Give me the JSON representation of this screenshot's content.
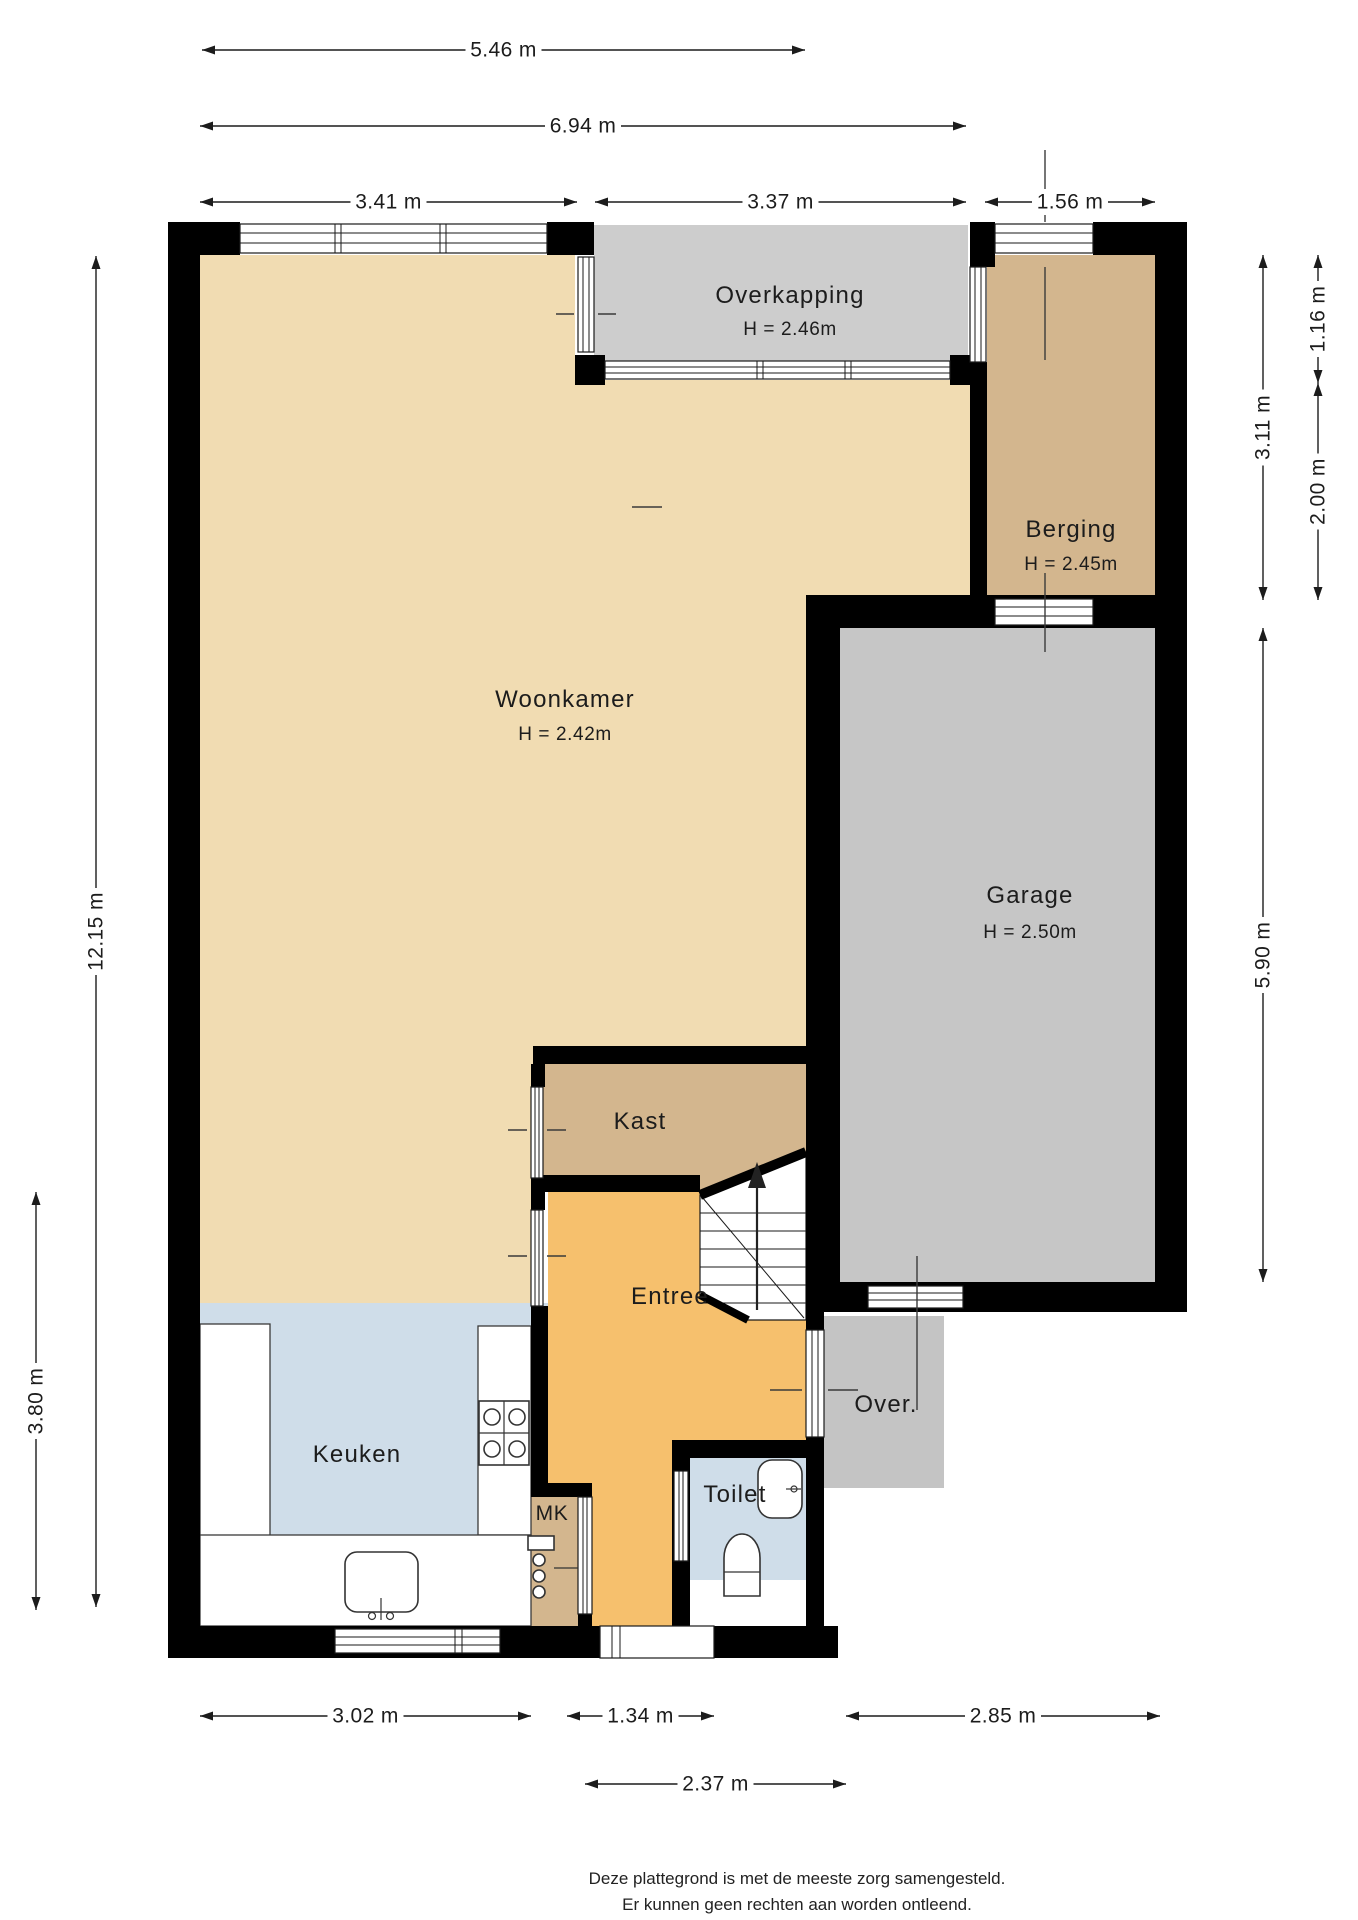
{
  "footer": {
    "line1": "Deze plattegrond is met de meeste zorg samengesteld.",
    "line2": "Er kunnen geen rechten aan worden ontleend."
  },
  "rooms": [
    {
      "id": "woonkamer",
      "label": "Woonkamer",
      "height": "H = 2.42m"
    },
    {
      "id": "overkapping",
      "label": "Overkapping",
      "height": "H = 2.46m"
    },
    {
      "id": "berging",
      "label": "Berging",
      "height": "H = 2.45m"
    },
    {
      "id": "garage",
      "label": "Garage",
      "height": "H = 2.50m"
    },
    {
      "id": "kast",
      "label": "Kast"
    },
    {
      "id": "entree",
      "label": "Entree"
    },
    {
      "id": "keuken",
      "label": "Keuken"
    },
    {
      "id": "mk",
      "label": "MK"
    },
    {
      "id": "toilet",
      "label": "Toilet"
    },
    {
      "id": "over",
      "label": "Over."
    }
  ],
  "colors": {
    "woonkamer": "#f1dcb2",
    "kast": "#d3b68e",
    "berging": "#d3b68e",
    "mk": "#d3b68e",
    "entree": "#f6c06d",
    "keuken": "#cfdde9",
    "toilet": "#cfdde9",
    "overkapping": "#cdcdcd",
    "garage": "#c6c6c6",
    "over": "#c4c4c4",
    "wall": "#000000"
  },
  "dimensions": [
    {
      "label": "5.46 m",
      "orient": "h",
      "x1": 202,
      "x2": 805,
      "y": 50
    },
    {
      "label": "6.94 m",
      "orient": "h",
      "x1": 200,
      "x2": 966,
      "y": 126
    },
    {
      "label": "3.41 m",
      "orient": "h",
      "x1": 200,
      "x2": 577,
      "y": 202
    },
    {
      "label": "3.37 m",
      "orient": "h",
      "x1": 595,
      "x2": 966,
      "y": 202
    },
    {
      "label": "1.56 m",
      "orient": "h",
      "x1": 985,
      "x2": 1155,
      "y": 202
    },
    {
      "label": "3.02 m",
      "orient": "h",
      "x1": 200,
      "x2": 531,
      "y": 1716
    },
    {
      "label": "1.34 m",
      "orient": "h",
      "x1": 567,
      "x2": 714,
      "y": 1716
    },
    {
      "label": "2.85 m",
      "orient": "h",
      "x1": 846,
      "x2": 1160,
      "y": 1716
    },
    {
      "label": "2.37 m",
      "orient": "h",
      "x1": 585,
      "x2": 846,
      "y": 1784
    },
    {
      "label": "12.15 m",
      "orient": "v",
      "y1": 256,
      "y2": 1607,
      "x": 96
    },
    {
      "label": "3.80 m",
      "orient": "v",
      "y1": 1192,
      "y2": 1610,
      "x": 36
    },
    {
      "label": "3.11 m",
      "orient": "v",
      "y1": 255,
      "y2": 600,
      "x": 1263
    },
    {
      "label": "5.90 m",
      "orient": "v",
      "y1": 628,
      "y2": 1282,
      "x": 1263
    },
    {
      "label": "1.16 m",
      "orient": "v",
      "y1": 255,
      "y2": 383,
      "x": 1318
    },
    {
      "label": "2.00 m",
      "orient": "v",
      "y1": 383,
      "y2": 600,
      "x": 1318
    }
  ],
  "icons": [
    {
      "name": "stairs-up-arrow-icon",
      "meaning": "staircase going up"
    },
    {
      "name": "stove-icon",
      "meaning": "4-burner hob"
    },
    {
      "name": "sink-icon",
      "meaning": "kitchen sink"
    },
    {
      "name": "toilet-icon",
      "meaning": "wall hung toilet"
    },
    {
      "name": "hand-basin-icon",
      "meaning": "toilet hand basin"
    },
    {
      "name": "meter-cabinet-icon",
      "meaning": "electrical meter panel"
    }
  ]
}
